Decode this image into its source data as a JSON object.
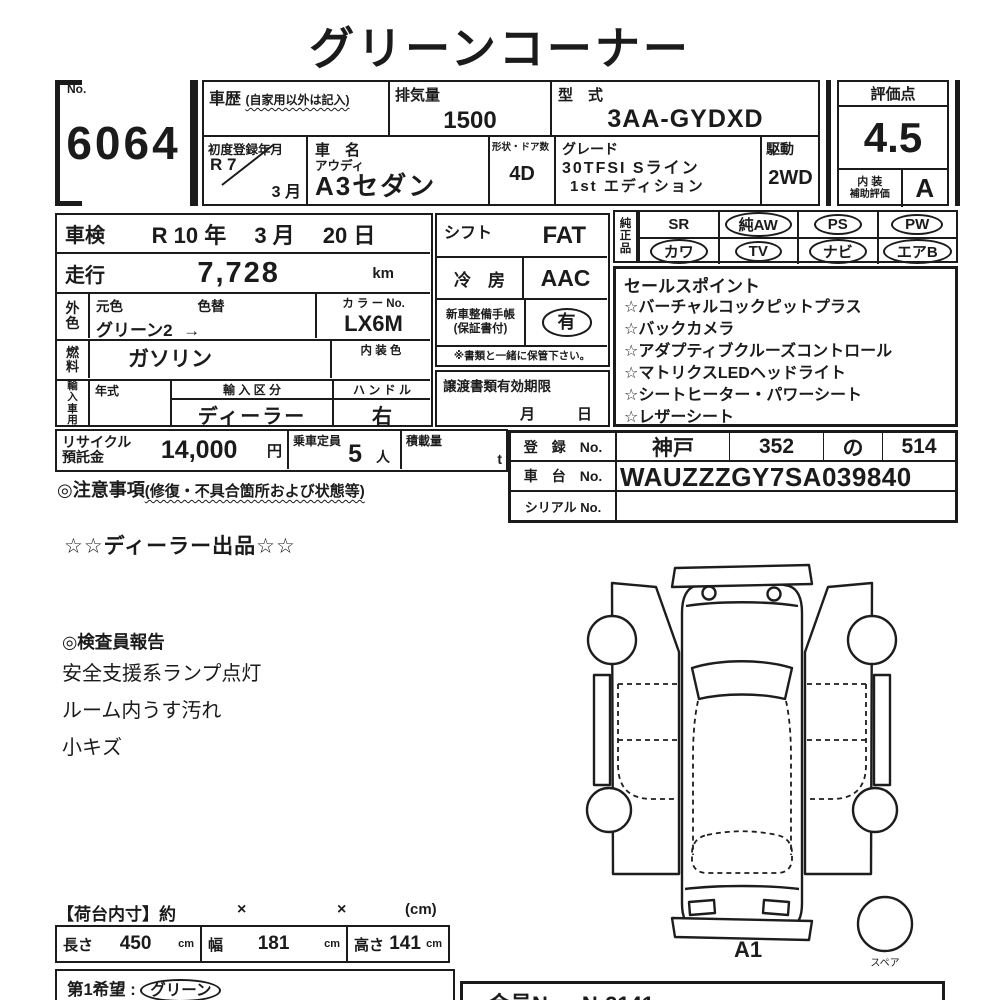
{
  "title": "グリーンコーナー",
  "lot": {
    "no_label": "No.",
    "no": "6064"
  },
  "head": {
    "history_label": "車歴",
    "history_note": "(自家用以外は記入)",
    "disp_label": "排気量",
    "disp_value": "1500",
    "model_label": "型　式",
    "model_value": "3AA-GYDXD",
    "firstreg_label": "初度登録年月",
    "firstreg_year": "R 7",
    "firstreg_month": "3 月",
    "name_label": "車　名",
    "maker": "アウディ",
    "name": "A3セダン",
    "doors_label": "形状・ドア数",
    "doors_value": "4D",
    "grade_label": "グレード",
    "grade_line1": "30TFSI Sライン",
    "grade_line2": "1st エディション",
    "drive_label": "駆動",
    "drive_value": "2WD"
  },
  "score": {
    "label": "評価点",
    "value": "4.5",
    "interior_label1": "内 装",
    "interior_label2": "補助評価",
    "interior_value": "A"
  },
  "spec": {
    "shaken_label": "車検",
    "shaken_value": "R 10 年　 3 月　 20 日",
    "run_label": "走行",
    "run_value": "7,728",
    "run_unit": "km",
    "ext_label": "外色",
    "orig_label": "元色",
    "change_label": "色替",
    "color_value": "グリーン2",
    "color_arrow": "→",
    "colorno_label": "カ ラ ー No.",
    "colorno_value": "LX6M",
    "fuel_label": "燃料",
    "fuel_value": "ガソリン",
    "intcolor_label": "内 装 色",
    "import_label": "輸入車用",
    "year_label": "年式",
    "importclass_label": "輸 入 区 分",
    "importclass_value": "ディーラー",
    "handle_label": "ハ ン ド ル",
    "handle_value": "右",
    "recycle_label1": "リサイクル",
    "recycle_label2": "預託金",
    "recycle_value": "14,000",
    "recycle_unit": "円",
    "pax_label": "乗車定員",
    "pax_value": "5",
    "pax_unit": "人",
    "load_label": "積載量",
    "load_unit": "t",
    "notice_label": "◎注意事項",
    "notice_note": "(修復・不具合箇所および状態等)"
  },
  "mid": {
    "shift_label": "シフト",
    "shift_value": "FAT",
    "ac_label": "冷　房",
    "ac_value": "AAC",
    "book_label1": "新車整備手帳",
    "book_label2": "(保証書付)",
    "book_value": "有",
    "keep_note": "※書類と一緒に保管下さい。",
    "transfer_label": "譲渡書類有効期限",
    "transfer_month": "月",
    "transfer_day": "日"
  },
  "equip": {
    "label": "純正品",
    "row1": [
      {
        "label": "SR",
        "circled": false
      },
      {
        "label": "純AW",
        "circled": true
      },
      {
        "label": "PS",
        "circled": true
      },
      {
        "label": "PW",
        "circled": true
      }
    ],
    "row2": [
      {
        "label": "カワ",
        "circled": true
      },
      {
        "label": "TV",
        "circled": true
      },
      {
        "label": "ナビ",
        "circled": true
      },
      {
        "label": "エアB",
        "circled": true
      }
    ]
  },
  "sales": {
    "label": "セールスポイント",
    "items": [
      "☆バーチャルコックピットプラス",
      "☆バックカメラ",
      "☆アダプティブクルーズコントロール",
      "☆マトリクスLEDヘッドライト",
      "☆シートヒーター・パワーシート",
      "☆レザーシート"
    ]
  },
  "reg": {
    "reg_label": "登　録　No.",
    "area": "神戸",
    "class_no": "352",
    "kana": "の",
    "number": "514",
    "chassis_label": "車　台　No.",
    "chassis_value": "WAUZZZGY7SA039840",
    "serial_label": "シリアル No.",
    "serial_value": ""
  },
  "notes": {
    "dealer": "☆☆ディーラー出品☆☆",
    "inspector_label": "◎検査員報告",
    "items": [
      "安全支援系ランプ点灯",
      "ルーム内うす汚れ",
      "小キズ"
    ]
  },
  "diagram": {
    "label": "A1",
    "spare": "スペア"
  },
  "cargo": {
    "header": "【荷台内寸】約",
    "times1": "×",
    "times2": "×",
    "unit": "(cm)",
    "len_label": "長さ",
    "len_value": "450",
    "len_unit": "cm",
    "wid_label": "幅",
    "wid_value": "181",
    "wid_unit": "cm",
    "hgt_label": "高さ",
    "hgt_value": "141",
    "hgt_unit": "cm"
  },
  "bottom": {
    "wish_label": "第1希望 :",
    "wish_value": "グリーン",
    "member_label": "会員No.",
    "member_value": "N-2141"
  }
}
